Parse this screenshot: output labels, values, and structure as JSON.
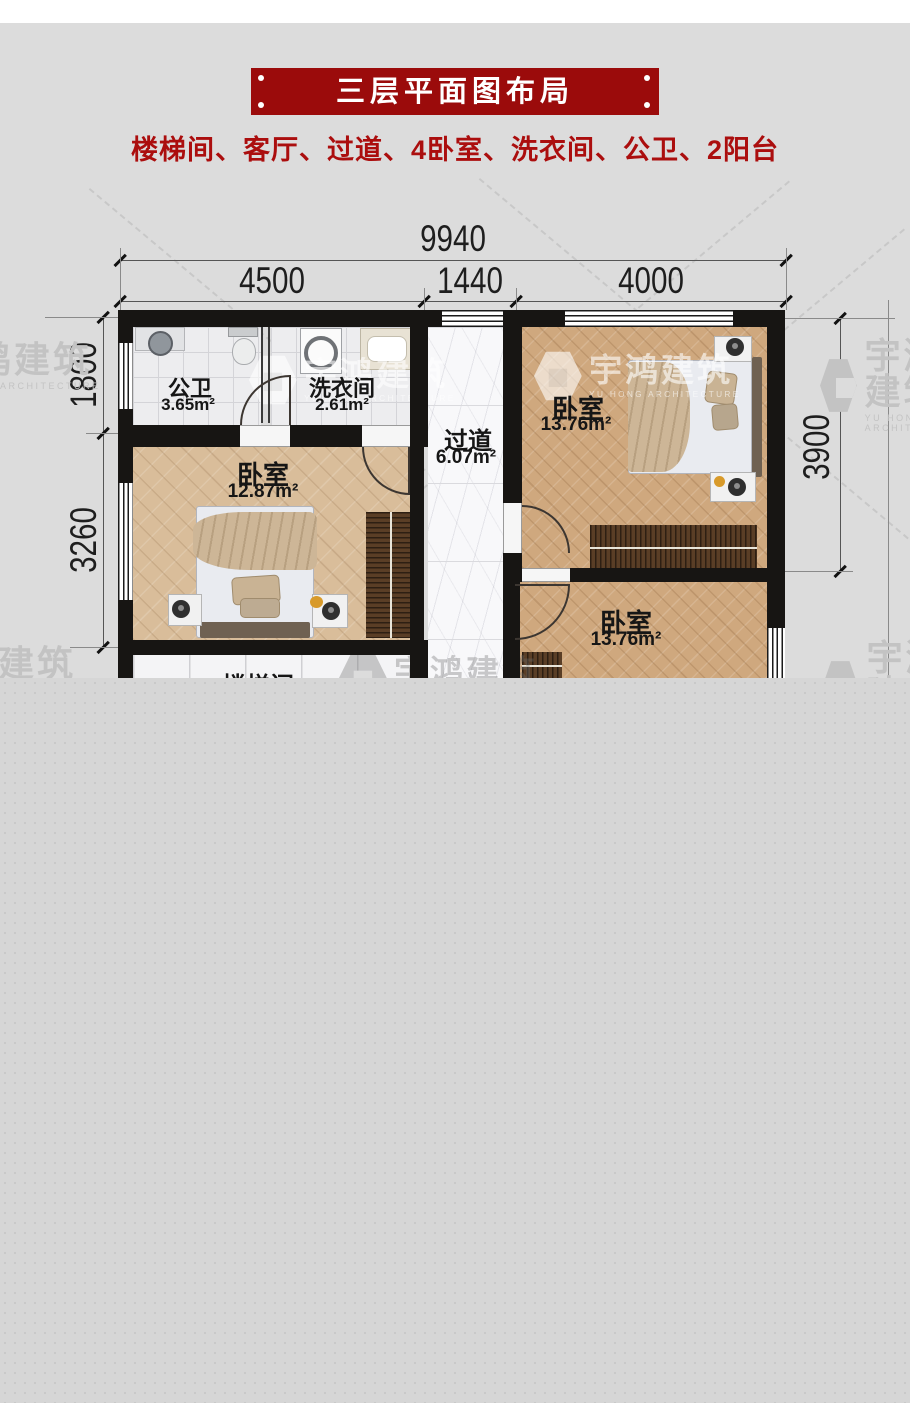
{
  "header": {
    "title": "三层平面图布局",
    "subtitle": "楼梯间、客厅、过道、4卧室、洗衣间、公卫、2阳台"
  },
  "dimensions": {
    "top_total": "9940",
    "top_segments": [
      "4500",
      "1440",
      "4000"
    ],
    "left_top": "1800",
    "left_bottom": "3260",
    "right": "3900"
  },
  "rooms": {
    "bathroom": {
      "name": "公卫",
      "area": "3.65m²"
    },
    "laundry": {
      "name": "洗衣间",
      "area": "2.61m²"
    },
    "hallway": {
      "name": "过道",
      "area": "6.07m²"
    },
    "bedroom_top_right": {
      "name": "卧室",
      "area": "13.76m²"
    },
    "bedroom_left": {
      "name": "卧室",
      "area": "12.87m²"
    },
    "bedroom_bottom_right": {
      "name": "卧室",
      "area": "13.76m²"
    },
    "stairwell": {
      "name": "楼梯间"
    }
  },
  "watermark": {
    "name": "宇鸿建筑",
    "tagline": "YU HONG ARCHITECTURE"
  },
  "colors": {
    "banner": "#9b0b0b",
    "subtitle_text": "#ab0e0e",
    "wall": "#171513",
    "wood": "#cfa87e",
    "wood_light": "#d9bd9a",
    "marble": "#f8f8fa",
    "tile": "#ededef",
    "background": "#dcdcdc",
    "cutoff_gray": "#d6d6d6"
  }
}
